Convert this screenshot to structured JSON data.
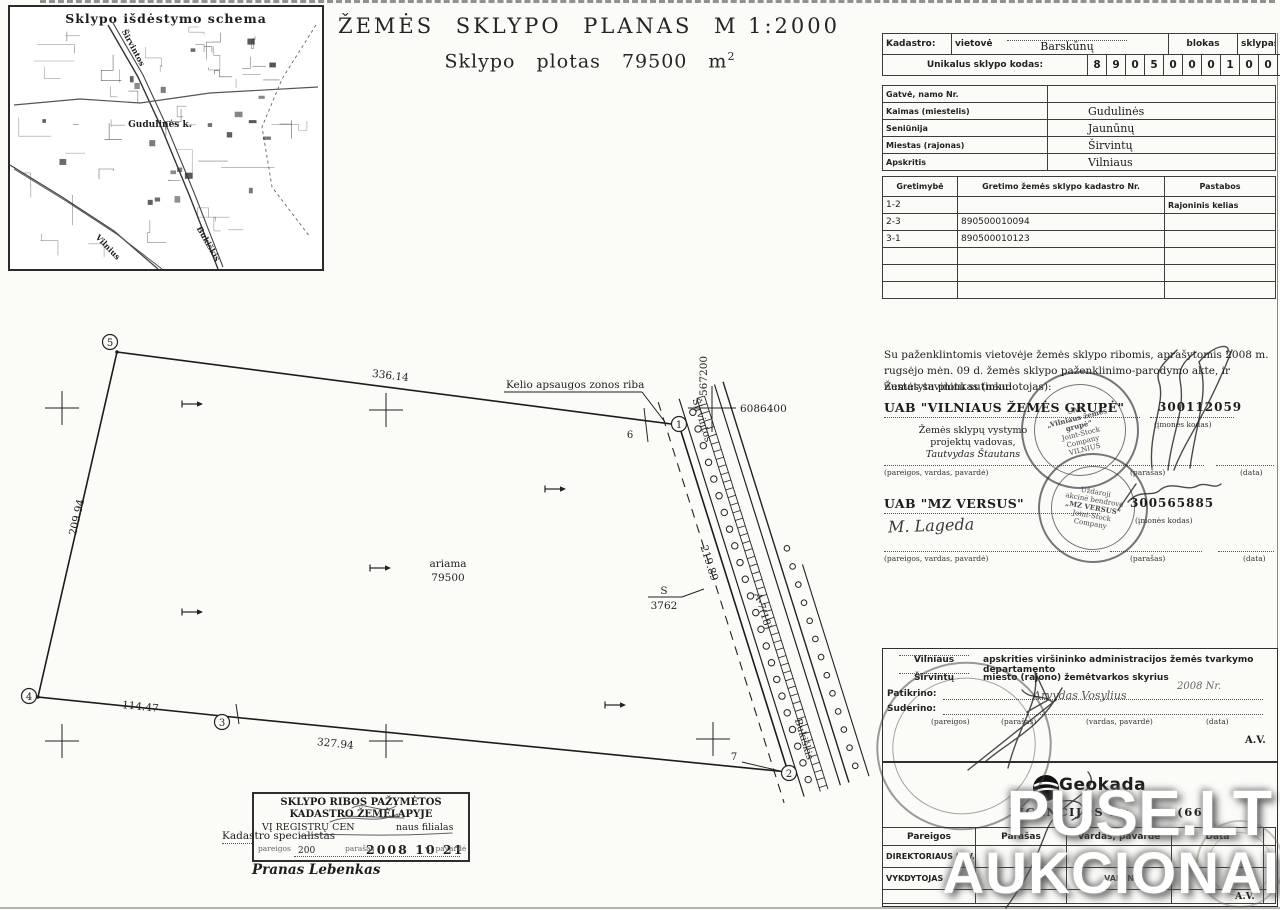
{
  "map": {
    "title": "Sklypo išdėstymo schema",
    "labels": {
      "road_top": "Širvintos",
      "village": "Gudulinės k.",
      "road_bottom_right": "Bukiškis",
      "road_bottom_left": "Vilnius"
    }
  },
  "title": {
    "w1": "ŽEMĖS",
    "w2": "SKLYPO",
    "w3": "PLANAS",
    "w4": "M 1:2000",
    "line2": "Sklypo plotas 79500 m",
    "sup": "2"
  },
  "cadastro": {
    "label": "Kadastro:",
    "vietove_label": "vietovė",
    "vietove_value": "Barskūnų",
    "blokas_label": "blokas",
    "sklypas_label": "sklypas",
    "code_label": "Unikalus sklypo kodas:",
    "code_digits": [
      "8",
      "9",
      "0",
      "5",
      "0",
      "0",
      "0",
      "1",
      "0",
      "0",
      "2",
      "2"
    ]
  },
  "location": {
    "rows": [
      {
        "label": "Gatvė, namo Nr.",
        "value": ""
      },
      {
        "label": "Kaimas (miestelis)",
        "value": "Gudulinės"
      },
      {
        "label": "Seniūnija",
        "value": "Jaunūnų"
      },
      {
        "label": "Miestas (rajonas)",
        "value": "Širvintų"
      },
      {
        "label": "Apskritis",
        "value": "Vilniaus"
      }
    ]
  },
  "adjacency": {
    "headers": [
      "Gretimybė",
      "Gretimo žemės sklypo kadastro Nr.",
      "Pastabos"
    ],
    "rows": [
      [
        "1-2",
        "",
        "Rajoninis kelias"
      ],
      [
        "2-3",
        "890500010094",
        ""
      ],
      [
        "3-1",
        "890500010123",
        ""
      ],
      [
        "",
        "",
        ""
      ],
      [
        "",
        "",
        ""
      ],
      [
        "",
        "",
        ""
      ]
    ]
  },
  "consent": {
    "text": "Su paženklintomis vietovėje žemės sklypo ribomis, aprašytomis 2008 m. rugsėjo mėn. 09 d. žemės sklypo paženklinimo-parodymo akte, ir nustatytu plotu sutinku:",
    "owner_label": "Žemės savininkas (naudotojas):"
  },
  "owner1": {
    "name": "UAB \"VILNIAUS ŽEMĖS GRUPĖ\"",
    "code": "300112059",
    "code_label": "(įmonės kodas)",
    "role1": "Žemės sklypų vystymo",
    "role2": "projektų vadovas,",
    "role3": "Tautvydas Štautans",
    "sig_label": "(pareigos, vardas, pavardė)",
    "sign_label": "(parašas)",
    "date_label": "(data)",
    "stamp": {
      "t1": "UAB",
      "t2": "„Vilniaus žemės grupė“",
      "t3": "Joint-Stock",
      "t4": "Company",
      "t5": "VILNIUS"
    }
  },
  "owner2": {
    "name": "UAB \"MZ VERSUS\"",
    "code": "300565885",
    "code_label": "(įmonės kodas)",
    "handwriting": "M. Lageda",
    "sig_label": "(pareigos, vardas, pavardė)",
    "sign_label": "(parašas)",
    "date_label": "(data)",
    "stamp": {
      "t1": "Uždaroji",
      "t2": "akcinė bendrovė",
      "t3": "„MZ VERSUS“",
      "t4": "Joint-Stock",
      "t5": "Company"
    }
  },
  "approval": {
    "county": "Vilniaus",
    "county_rest": "apskrities viršininko administracijos žemės tvarkymo departamento",
    "district": "Širvintų",
    "district_rest": "miesto (rajono) žemėtvarkos skyrius",
    "checked_label": "Patikrino:",
    "agreed_label": "Suderino:",
    "name_hw": "Arvydas Vosylius",
    "year_hw": "2008  Nr.",
    "col1": "(pareigos)",
    "col2": "(parašas)",
    "col3": "(vardas, pavardė)",
    "col4": "(data)",
    "av": "A.V."
  },
  "license": {
    "logo": "Geokada",
    "line_label": "LICENCIJOS  Nr.",
    "line_fragment": "……-(66",
    "headers": [
      "Pareigos",
      "Parašas",
      "Vardas, pavardė",
      "Data"
    ],
    "rows": [
      [
        "DIREKTORIAUS  PAV.",
        "",
        "",
        ""
      ],
      [
        "VYKDYTOJAS",
        "",
        "VALUN",
        ""
      ]
    ],
    "av": "A.V."
  },
  "boundary_stamp": {
    "l1": "SKLYPO RIBOS PAŽYMĖTOS",
    "l2": "KADASTRO ŽEMĖLAPYJE",
    "l3a": "VĮ REGISTRŲ CEN",
    "l3b": "naus filialas",
    "role": "Kadastro specialistas",
    "sub1": "pareigos",
    "sub2": "parašas",
    "sub3": "v., pavardė",
    "year": "200",
    "date_hw": "2008 10 21",
    "name": "Pranas Lebenkas"
  },
  "plot": {
    "zone_label": "Kelio apsaugos zonos riba",
    "coord_v": "567200",
    "coord_h": "6086400",
    "road_top": "Širvintos",
    "road_no": "A-7(18)",
    "road_bottom": "Bukiškis",
    "area1": "ariama",
    "area2": "79500",
    "s_label": "S",
    "s_value": "3762",
    "dims": {
      "top": "336.14",
      "left": "209.94",
      "bottom1": "114.47",
      "bottom2": "327.94",
      "road": "219.89"
    },
    "points": {
      "p1": "1",
      "p2": "2",
      "p3": "3",
      "p4": "4",
      "p5": "5",
      "p6": "6",
      "p7": "7"
    }
  },
  "watermark": {
    "line1": "PUSE.LT",
    "line2": "AUKCIONAI"
  }
}
